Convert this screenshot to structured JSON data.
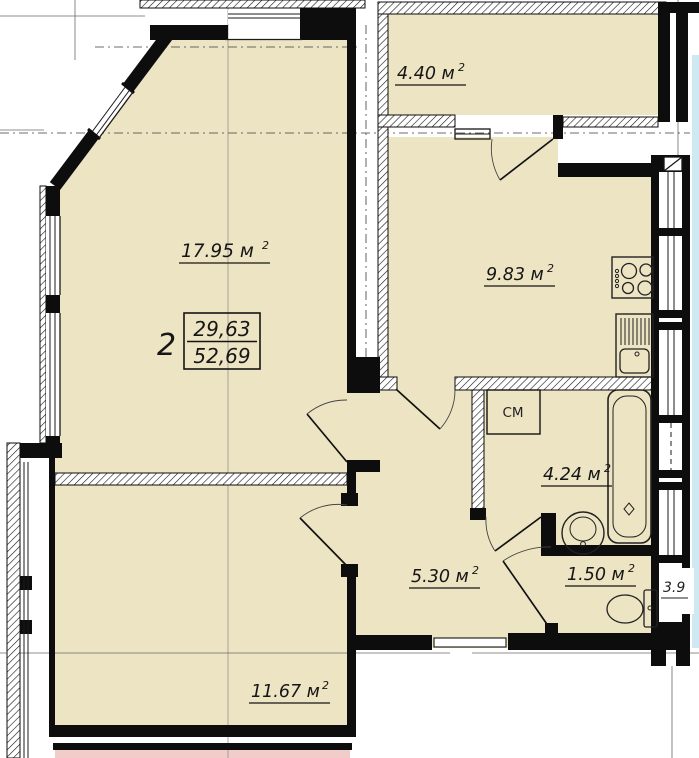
{
  "apartment": {
    "number": "2",
    "living_area": "29,63",
    "total_area": "52,69"
  },
  "rooms": [
    {
      "id": "living-room",
      "area_label": "17.95 м",
      "sup": "2"
    },
    {
      "id": "balcony",
      "area_label": "4.40 м",
      "sup": "2"
    },
    {
      "id": "kitchen",
      "area_label": "9.83 м",
      "sup": "2"
    },
    {
      "id": "bathroom",
      "area_label": "4.24 м",
      "sup": "2"
    },
    {
      "id": "hallway",
      "area_label": "5.30 м",
      "sup": "2"
    },
    {
      "id": "wc",
      "area_label": "1.50 м",
      "sup": "2"
    },
    {
      "id": "bedroom",
      "area_label": "11.67 м",
      "sup": "2"
    }
  ],
  "fixtures": {
    "washing_machine_label": "СМ"
  },
  "adjacent": {
    "partial_area_label": "3.9"
  },
  "colors": {
    "room_fill": "#ece4c3",
    "neighbor_balcony_fill": "#f2ccc8",
    "adjacent_room_fill": "#cfe9f2",
    "wall": "#0d0d0d"
  }
}
